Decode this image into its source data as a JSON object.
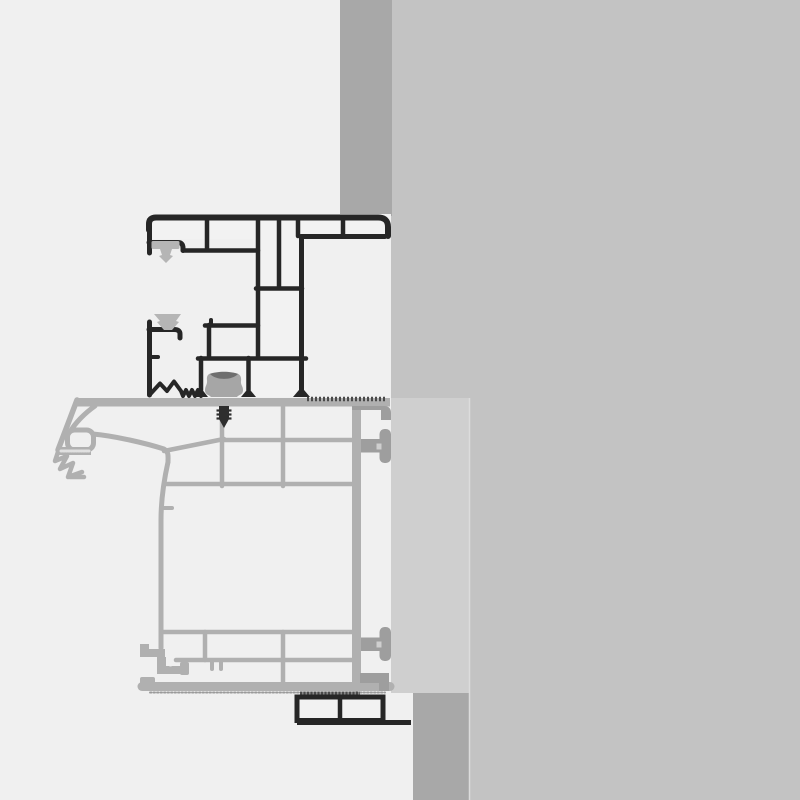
{
  "title": "Window frame installation cross-section detail drawing",
  "parts": {
    "wall": "masonry-wall-section",
    "top_band": "wall-reveal-band-top",
    "bottom_band": "wall-reveal-band-bottom",
    "panel": "insulation-panel",
    "dark_profile": "frame-profile-cross-section",
    "gray_profile": "sash-profile-cross-section",
    "gasket_top": "sealing-gasket-upper",
    "gasket_bottom": "sealing-gasket-lower",
    "grommet": "sealing-grommet",
    "screw": "fixing-screw",
    "anchor_top": "t-bolt-anchor-upper",
    "anchor_bottom": "t-bolt-anchor-lower",
    "bottom_profile": "glazing-bead-profile"
  },
  "colors": {
    "background_left": "#f0f0f0",
    "wall": "#c3c3c3",
    "band": "#a8a8a8",
    "panel": "#cfcfcf",
    "seam": "#dcdcdc",
    "frame_outline": "#262626",
    "frame_fill": "#f2f2f2",
    "profile_gray": "#b0b0b0",
    "profile_fill": "#efefef",
    "gasket": "#b5b5b5",
    "anchor": "#9e9e9e",
    "grommet": "#a6a6a6",
    "grommet_shadow": "#6e6e6e",
    "screw": "#2e2e2e",
    "hatch": "#4a4a4a",
    "hatch_light": "#8a8a8a",
    "dot_edge": "#9a9a9a"
  }
}
